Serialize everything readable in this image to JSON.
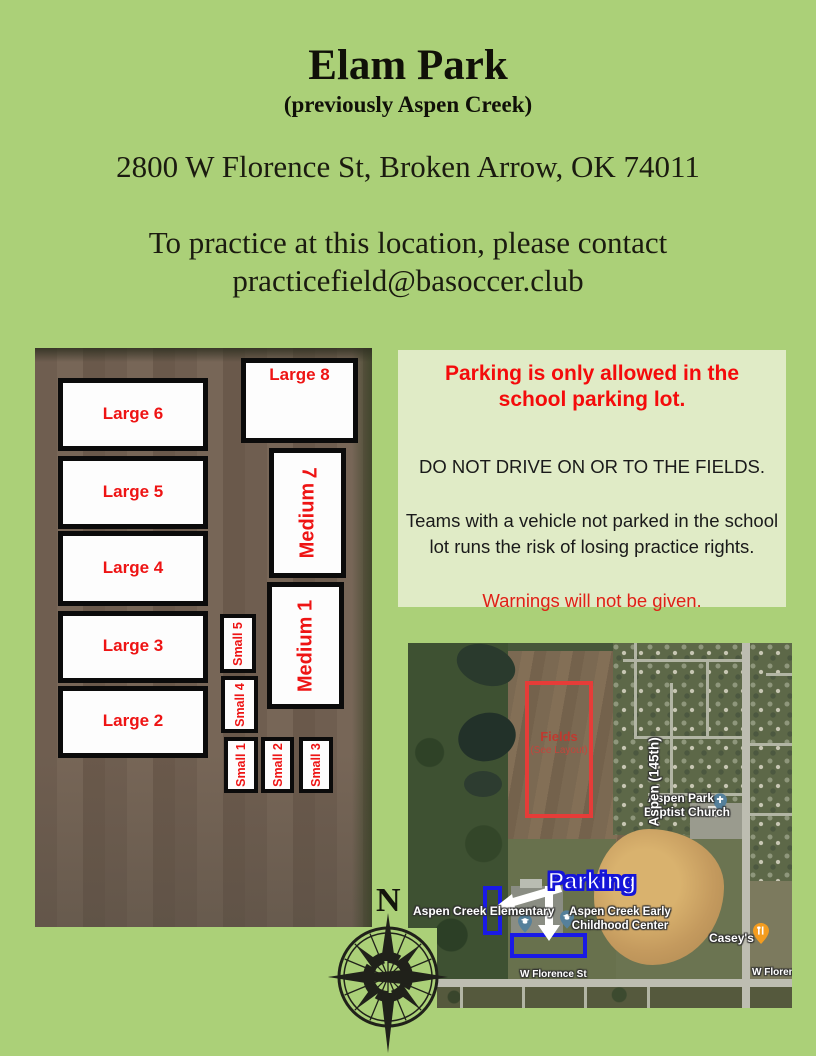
{
  "flyer": {
    "title": "Elam Park",
    "subtitle": "(previously Aspen Creek)",
    "address": "2800 W Florence St, Broken Arrow, OK 74011",
    "contact_intro": "To practice at this location, please contact",
    "contact_email": "practicefield@basoccer.club"
  },
  "notice": {
    "heading": "Parking is only allowed in the school parking lot.",
    "rule": "DO NOT DRIVE ON OR TO THE FIELDS.",
    "consequence": "Teams with a vehicle not parked in the school lot runs the risk of losing practice rights.",
    "warning": "Warnings will not be given."
  },
  "field_layout": {
    "large8": "Large 8",
    "large6": "Large 6",
    "large5": "Large 5",
    "large4": "Large 4",
    "large3": "Large 3",
    "large2": "Large 2",
    "medium7_word": "Medium",
    "medium7_num": "7",
    "medium1": "Medium 1",
    "small5": "Small 5",
    "small4": "Small 4",
    "small1": "Small 1",
    "small2": "Small 2",
    "small3": "Small 3"
  },
  "map": {
    "fields_title": "Fields",
    "fields_sub": "(See Layout)",
    "church_line1": "Aspen Park",
    "church_line2": "Baptist Church",
    "road_vertical": "Aspen (145th)",
    "parking": "Parking",
    "elementary": "Aspen Creek Elementary",
    "early_line1": "Aspen Creek Early",
    "early_line2": "Childhood Center",
    "caseys": "Casey's",
    "florence": "W Florence St",
    "florence_clipped": "W Floren"
  },
  "compass": {
    "north": "N"
  },
  "colors": {
    "page_bg": "#abd078",
    "notice_bg": "#e0ebc6",
    "heading_red": "#f40b0b",
    "field_label_red": "#ee1414",
    "parking_blue": "#1515d8",
    "fields_box_red": "#e63c38",
    "parking_rect_blue": "#1a1ae6"
  }
}
